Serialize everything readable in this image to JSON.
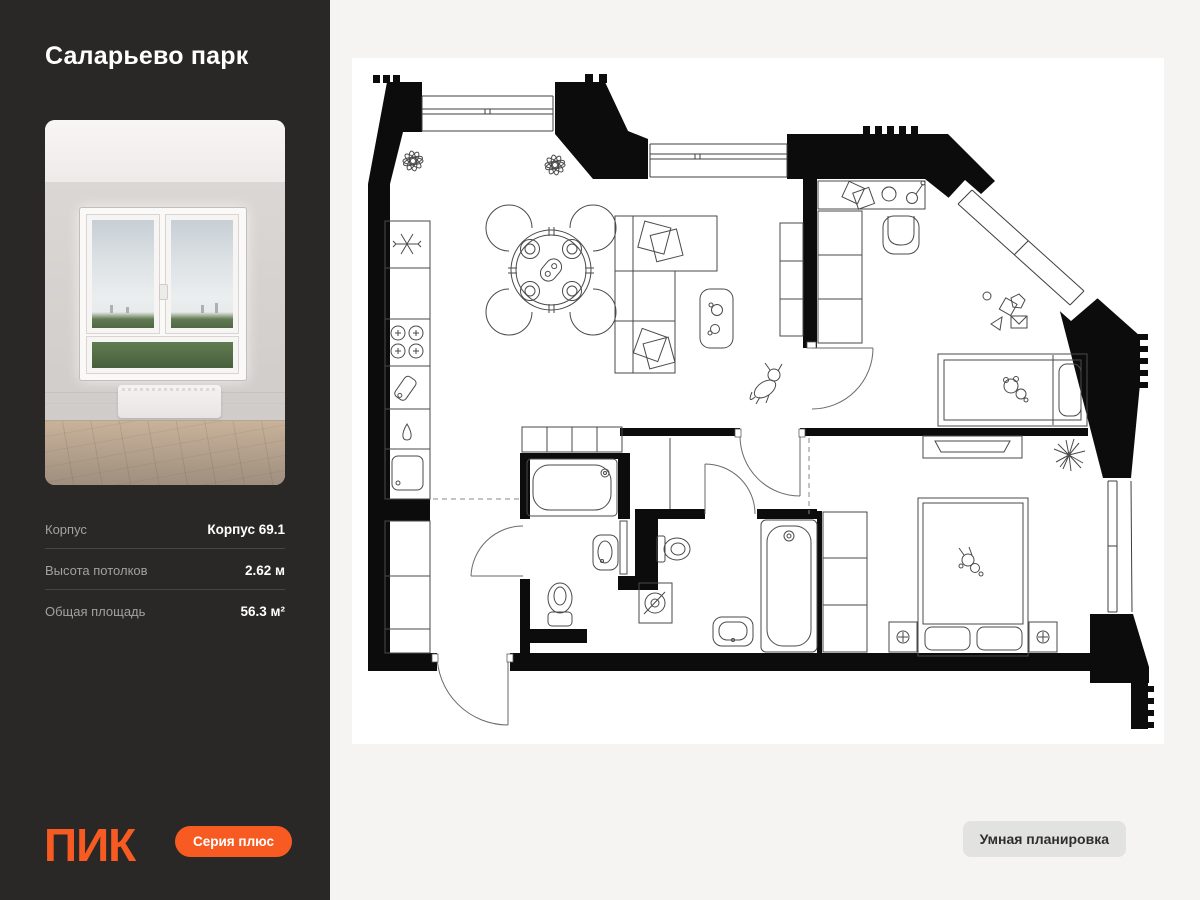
{
  "sidebar": {
    "title": "Саларьево парк",
    "details": [
      {
        "label": "Корпус",
        "value": "Корпус 69.1"
      },
      {
        "label": "Высота потолков",
        "value": "2.62 м"
      },
      {
        "label": "Общая площадь",
        "value": "56.3 м²"
      }
    ],
    "logo_text": "ПИК",
    "series_badge": "Серия плюс"
  },
  "main": {
    "smart_plan_button": "Умная планировка"
  },
  "colors": {
    "accent_orange": "#F85B22",
    "sidebar_bg": "#2A2827",
    "page_bg": "#F5F4F2",
    "plan_wall": "#0C0C0C"
  }
}
